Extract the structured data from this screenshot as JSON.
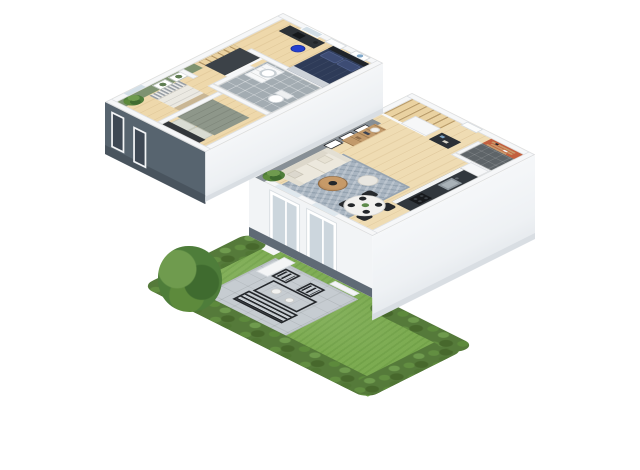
{
  "scene": {
    "description": "3D isometric dollhouse floor plan render of a two-story home with garden",
    "background": "#ffffff"
  },
  "palette": {
    "exterior_shadow_wall": "#57646f",
    "slab_edge": "#49545e",
    "wall_top": "#f6f7f8",
    "wall_face_light": "#f1f4f6",
    "green_accent_wall": "#7e9371",
    "gray_accent_wall": "#878f96",
    "orange_accent_wall": "#c2603f",
    "wood_floor": "#efdcb3",
    "bathroom_tile": "#a3acb2",
    "entry_tile": "#5e6468",
    "stairs_wood": "#ead2a1",
    "rug": "#a9b5c1",
    "sofa": "#ece8dd",
    "coffee_table_wood": "#b9905e",
    "pouf": "#e9e7e1",
    "dining_table": "#f2f1ef",
    "chair_black": "#26292d",
    "navy_duvet": "#2e3b58",
    "sage_duvet": "#8e978a",
    "white_duvet": "#ebe9e2",
    "headboard_dark": "#33373b",
    "desk_black": "#2d3237",
    "stool_blue": "#2540cf",
    "kitchen_worktop": "#31373d",
    "sink_steel": "#8d969d",
    "cooktop_black": "#17191c",
    "sideboard_wood": "#c29a6b",
    "shelf_wood": "#c99a6b",
    "grass": "#7cab51",
    "hedge": "#557a3a",
    "patio_stone": "#c6ccd1",
    "outdoor_metal": "#26292d",
    "plant_green": "#4e7d3a",
    "window_glass": "#ccd6dd"
  },
  "floors": [
    {
      "id": "upper-floor",
      "rooms": [
        {
          "name": "bedroom-office",
          "accent": null,
          "furniture": [
            "desk",
            "laptop",
            "desk-lamp",
            "blue-stool",
            "navy-double-bed",
            "world-map-art",
            "window",
            "door"
          ]
        },
        {
          "name": "bathroom",
          "accent": null,
          "furniture": [
            "vanity-drawers",
            "sink",
            "toilet"
          ]
        },
        {
          "name": "landing-hallway",
          "accent": null,
          "furniture": [
            "stair-void",
            "railing"
          ]
        },
        {
          "name": "bedroom-sage",
          "accent": null,
          "furniture": [
            "sage-double-bed",
            "headboard",
            "pillows"
          ]
        },
        {
          "name": "bedroom-green",
          "accent": "green_accent_wall",
          "furniture": [
            "single-bed-striped-pillows",
            "botanical-frame-1",
            "botanical-frame-2",
            "potted-plant",
            "window"
          ]
        }
      ]
    },
    {
      "id": "lower-floor",
      "rooms": [
        {
          "name": "living-room",
          "accent": "gray_accent_wall",
          "furniture": [
            "sofa",
            "throw-pillows",
            "area-rug",
            "coffee-table",
            "pouf",
            "floor-plant",
            "sideboard",
            "table-lamp",
            "photo-frame-1",
            "photo-frame-2",
            "photo-frame-3"
          ]
        },
        {
          "name": "dining-area",
          "accent": null,
          "furniture": [
            "round-marble-table",
            "black-chair-1",
            "black-chair-2",
            "black-chair-3",
            "black-chair-4",
            "place-settings",
            "centerpiece"
          ]
        },
        {
          "name": "kitchen",
          "accent": null,
          "furniture": [
            "counter-run",
            "sink",
            "faucet",
            "cooktop",
            "tall-cabinet"
          ]
        },
        {
          "name": "entry-hall",
          "accent": "orange_accent_wall",
          "furniture": [
            "wall-shelf-1",
            "wall-shelf-2",
            "wall-shelf-3",
            "front-door",
            "dark-tile-floor"
          ]
        },
        {
          "name": "staircase",
          "accent": null,
          "furniture": [
            "wood-winder-stairs",
            "under-stair-closet",
            "console-shelf"
          ]
        }
      ]
    }
  ],
  "garden": {
    "id": "garden",
    "elements": [
      "lawn",
      "hedge-left",
      "hedge-bottom",
      "hedge-right",
      "hedge-top-right",
      "stone-patio",
      "outdoor-table",
      "outdoor-chair-1",
      "outdoor-chair-2",
      "outdoor-bench",
      "tableware",
      "tree",
      "planter-wall-1",
      "planter-wall-2",
      "planter-wall-3"
    ]
  },
  "exterior": {
    "elements": [
      "upper-shadow-facade",
      "upper-facade-window-1",
      "upper-facade-window-2",
      "upper-light-facade",
      "lower-garden-facade",
      "facade-window-living",
      "facade-window-dining",
      "foundation-slab",
      "lower-light-facade"
    ]
  }
}
